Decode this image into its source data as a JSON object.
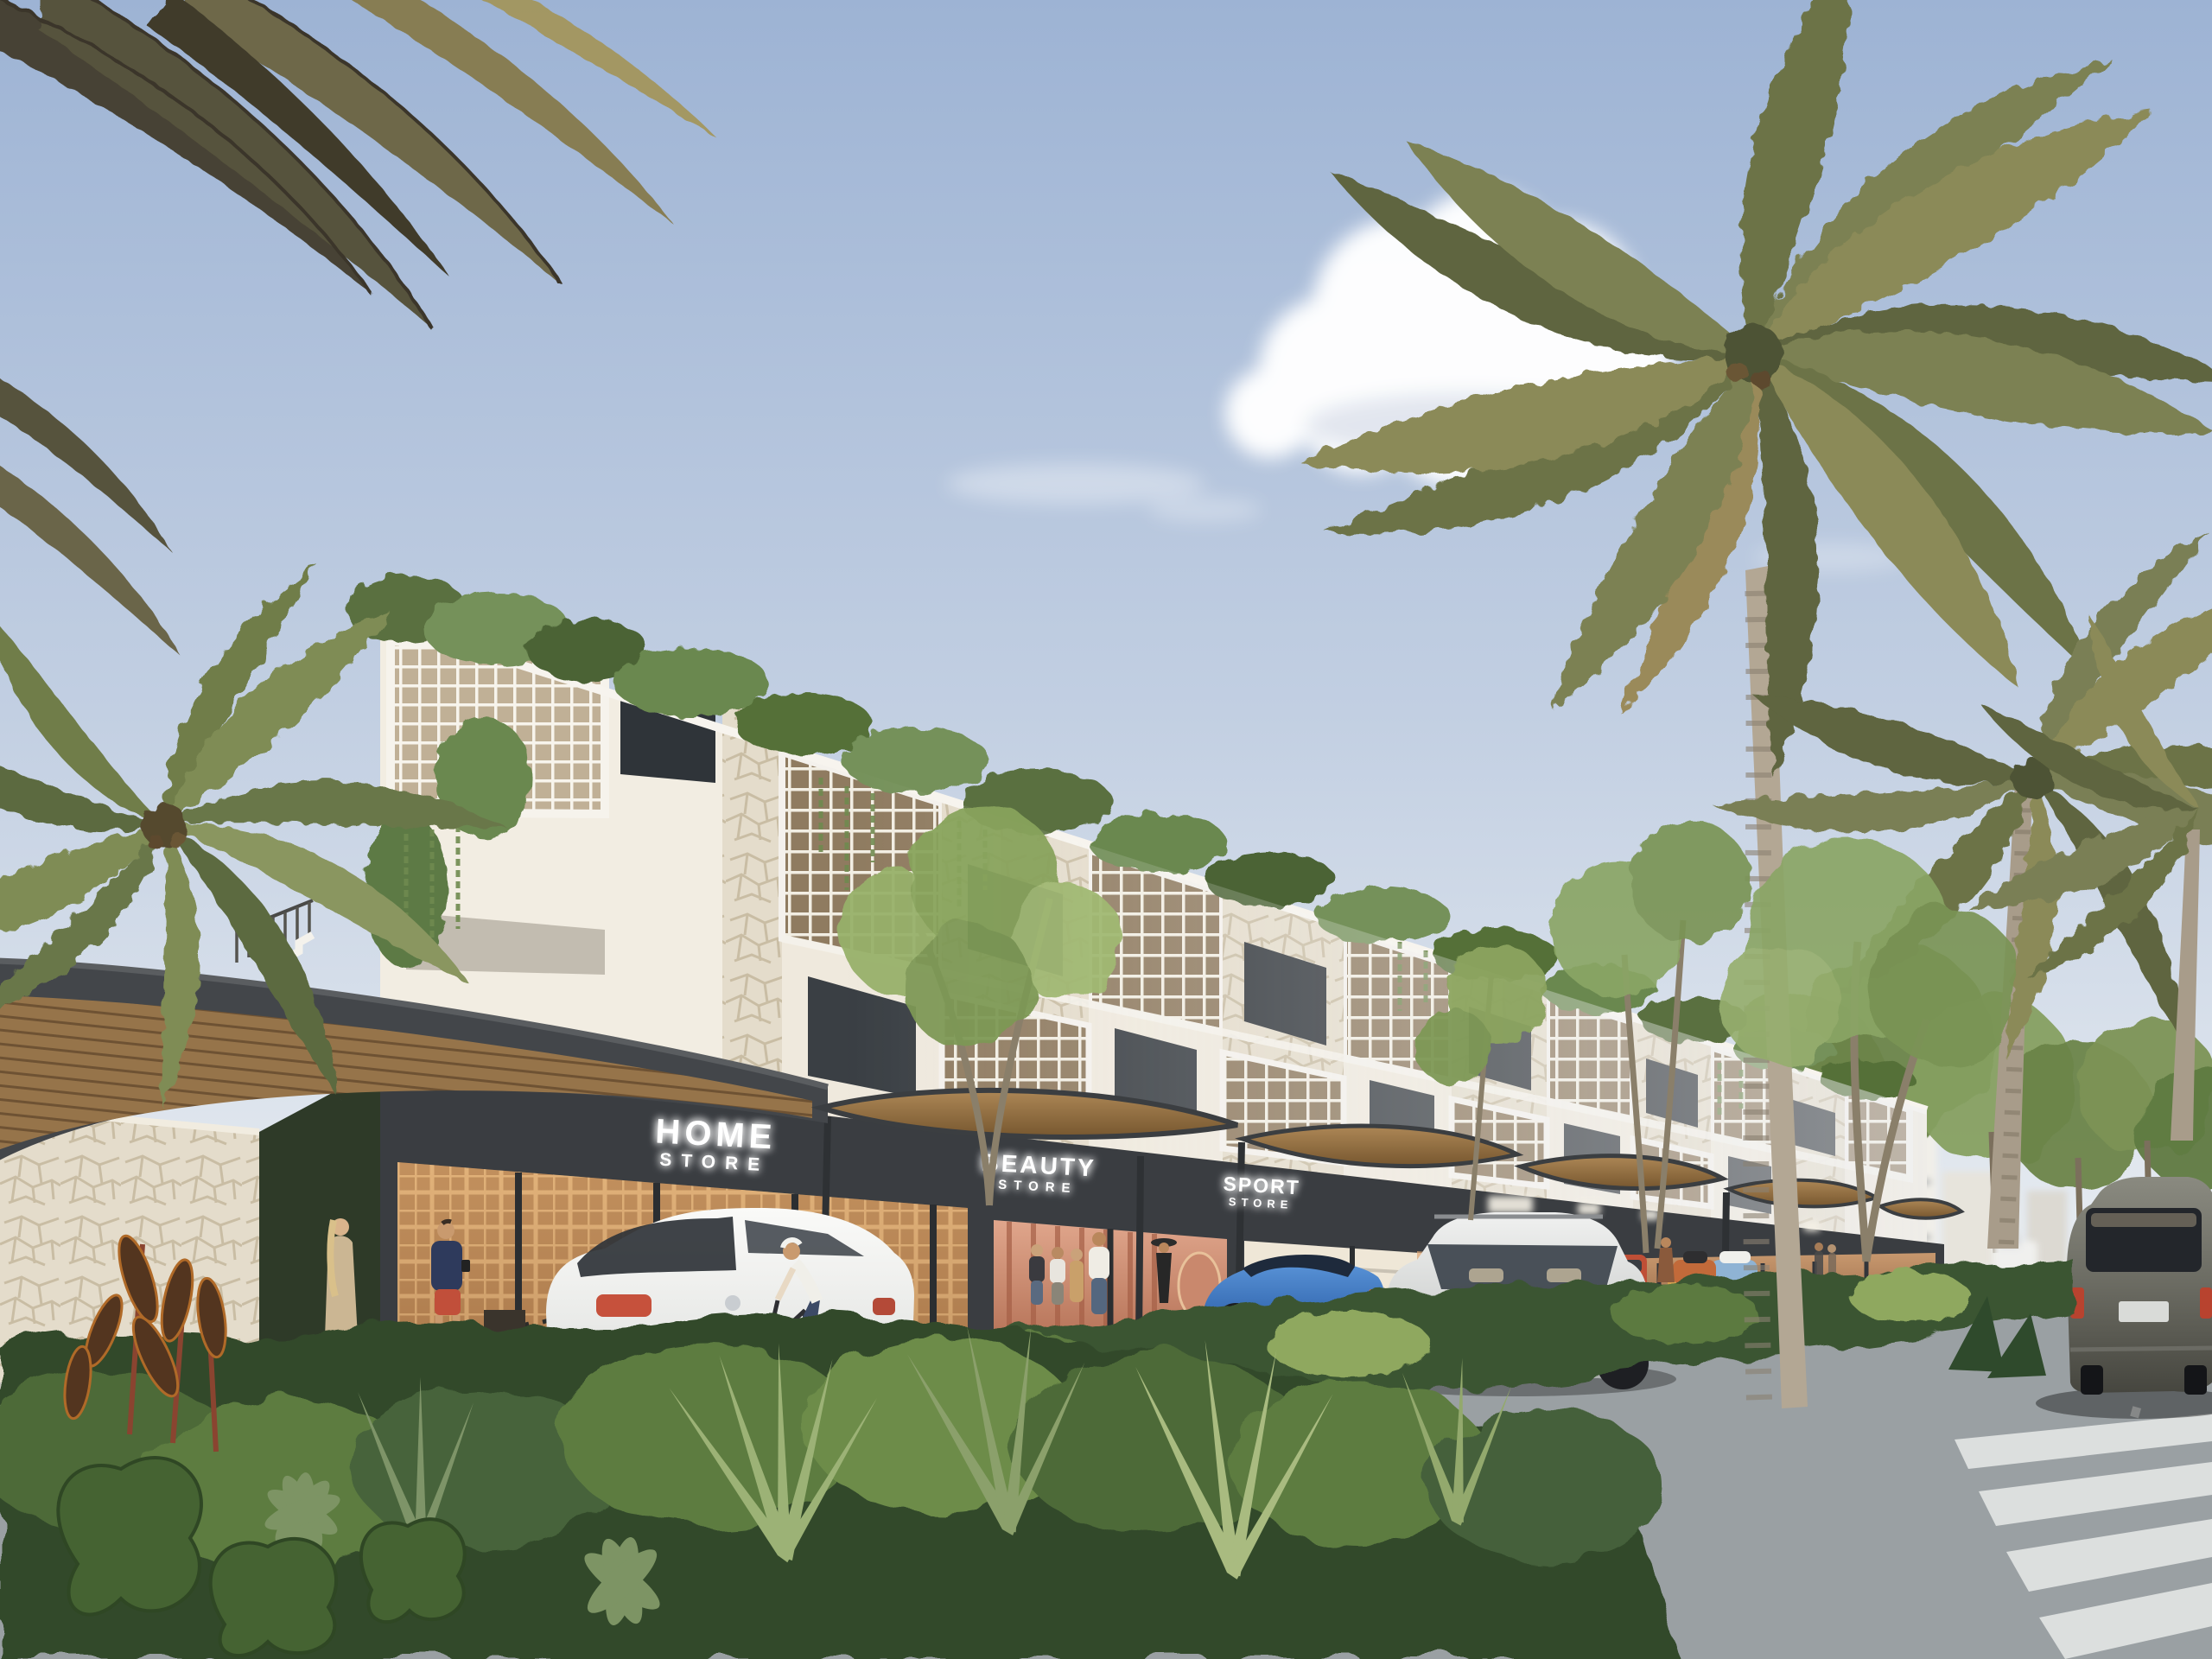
{
  "meta": {
    "title": "Tropical mixed-use retail street - architectural rendering",
    "scene_type": "photorealistic exterior render, daytime"
  },
  "signs": {
    "home": {
      "line1": "HOME",
      "line2": "STORE"
    },
    "beauty": {
      "line1": "BEAUTY",
      "line2": "STORE"
    },
    "sport": {
      "line1": "SPORT",
      "line2": "STORE"
    },
    "distant_unreadable_sign_count": 4
  },
  "palette": {
    "sky_top": "#9db3d4",
    "sky_mid": "#c2cfe2",
    "sky_horizon": "#eaeef2",
    "cloud_white": "#ffffff",
    "facade_white": "#efe9dd",
    "stone_light": "#e4dccb",
    "lattice_cream": "#f2eee3",
    "storefront_dark": "#3a3d41",
    "canopy_fascia": "#43464a",
    "canopy_wood": "#a07c4e",
    "sidewalk_gray": "#b9b7b0",
    "asphalt_gray": "#9aa0a3",
    "curb_yellow": "#d6b855",
    "foliage_dark": "#3a5530",
    "foliage_mid": "#5c7a3f",
    "foliage_light": "#8fa85e",
    "palm_olive": "#747a4d",
    "palm_trunk": "#b3a794",
    "sign_glow_white": "#ffffff"
  },
  "vehicles": [
    {
      "name": "white-hatchback-parked",
      "color": "#f1f2f0"
    },
    {
      "name": "blue-coupe-parked",
      "color": "#4a86cc"
    },
    {
      "name": "silver-suv-parked",
      "color": "#d4d6d5"
    },
    {
      "name": "white-compact-parked",
      "color": "#eceeed"
    },
    {
      "name": "red-compact-parked",
      "color": "#bf4f36"
    },
    {
      "name": "orange-sportscar-parked",
      "color": "#c26a3a"
    },
    {
      "name": "lightblue-classic-parked",
      "color": "#8fb3d4"
    },
    {
      "name": "dark-suv-driving",
      "color": "#6b6b62"
    },
    {
      "name": "white-pickup-distant",
      "color": "#f0f0ee"
    }
  ],
  "people": {
    "count": 12,
    "notable": [
      "woman-walking-beige-dress",
      "man-checking-phone",
      "cyclist-riding",
      "shoppers-at-storefronts",
      "woman-with-sun-hat"
    ]
  },
  "nature": {
    "palms": 5,
    "street_trees": "row along boulevard",
    "foreground": [
      "ferns",
      "crotons",
      "schefflera",
      "philodendron"
    ]
  }
}
